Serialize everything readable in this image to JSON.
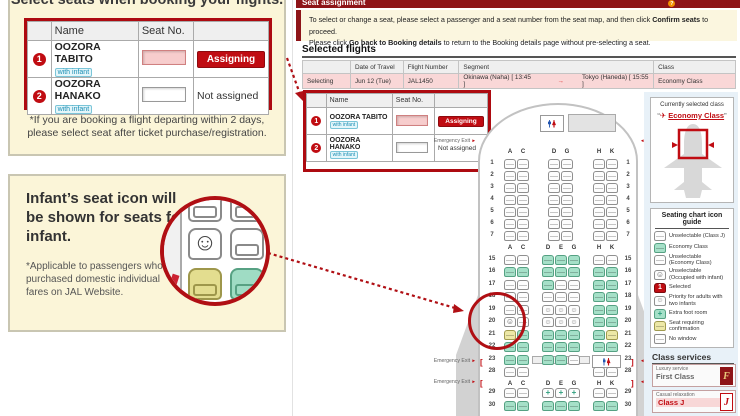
{
  "colors": {
    "brand_red": "#AD0A10",
    "accent_red": "#C00C12",
    "seat_available_green": "#A5E0C8",
    "seat_confirm_yellow": "#EDE8A6",
    "flight_row_pink": "#F9D7D7",
    "info_bg_yellow": "#FBF5D8"
  },
  "left": {
    "box1": {
      "title": "Select seats when booking your flights.",
      "note1": "*If you are booking a flight departing within 2 days,",
      "note2": "please select seat after ticket purchase/registration."
    },
    "box2": {
      "title": "Infant’s seat icon will be shown for seats for infant.",
      "note": "*Applicable to passengers who purchased domestic individual fares on JAL Website."
    }
  },
  "header": {
    "title": "Seat assignment",
    "help": "How to use this page",
    "instructions": [
      [
        {
          "t": "To select or change a seat, please select a passenger and a seat number from the seat map, and then click "
        },
        {
          "t": "Confirm seats",
          "b": true
        },
        {
          "t": " to proceed."
        }
      ],
      [
        {
          "t": "Please click "
        },
        {
          "t": "Go back to Booking details",
          "b": true
        },
        {
          "t": " to return to the Booking details page without pre-selecting a seat."
        }
      ]
    ]
  },
  "selected_flights": {
    "heading": "Selected flights",
    "headers": [
      "",
      "Date of Travel",
      "Flight Number",
      "Segment",
      "Class"
    ],
    "row": {
      "status": "Selecting",
      "date": "Jun 12 (Tue)",
      "flight": "JAL1450",
      "seg_from": "Okinawa (Naha) [ 13:45 ]",
      "arrow": "→",
      "seg_to": "Tokyo (Haneda) [ 15:55 ]",
      "class": "Economy Class"
    }
  },
  "passengers": {
    "headers": [
      "Name",
      "Seat No."
    ],
    "rows": [
      {
        "num": "1",
        "name": "OOZORA TABITO",
        "badge": "with infant",
        "status": "Assigning",
        "assigning": true
      },
      {
        "num": "2",
        "name": "OOZORA HANAKO",
        "badge": "with infant",
        "status": "Not assigned",
        "assigning": false
      }
    ]
  },
  "seat_map": {
    "exit_label": "Emergency Exit",
    "letters_j": [
      "A",
      "C",
      "D",
      "G",
      "H",
      "K"
    ],
    "letters_e": [
      "A",
      "C",
      "D",
      "E",
      "G",
      "H",
      "K"
    ],
    "letters_exit28": [
      "A",
      "C",
      "H",
      "K"
    ],
    "rows": [
      {
        "num": "1",
        "section": "j",
        "cols": {
          "A": "w",
          "C": "w",
          "D": "w",
          "G": "w",
          "H": "w",
          "K": "w"
        }
      },
      {
        "num": "2",
        "section": "j",
        "cols": {
          "A": "w",
          "C": "w",
          "D": "w",
          "G": "w",
          "H": "w",
          "K": "w"
        }
      },
      {
        "num": "3",
        "section": "j",
        "cols": {
          "A": "w",
          "C": "w",
          "D": "w",
          "G": "w",
          "H": "w",
          "K": "w"
        }
      },
      {
        "num": "4",
        "section": "j",
        "cols": {
          "A": "w",
          "C": "w",
          "D": "w",
          "G": "w",
          "H": "w",
          "K": "w"
        }
      },
      {
        "num": "5",
        "section": "j",
        "cols": {
          "A": "w",
          "C": "w",
          "D": "w",
          "G": "w",
          "H": "w",
          "K": "w"
        }
      },
      {
        "num": "6",
        "section": "j",
        "cols": {
          "A": "w",
          "C": "w",
          "D": "w",
          "G": "w",
          "H": "w",
          "K": "w"
        }
      },
      {
        "num": "7",
        "section": "j",
        "cols": {
          "A": "w",
          "C": "w",
          "D": "w",
          "G": "w",
          "H": "w",
          "K": "w"
        }
      },
      {
        "num": "15",
        "section": "e",
        "cols": {
          "A": "w",
          "C": "w",
          "D": "g",
          "E": "g",
          "G": "g",
          "H": "w",
          "K": "w"
        }
      },
      {
        "num": "16",
        "section": "e",
        "cols": {
          "A": "g",
          "C": "g",
          "D": "g",
          "E": "g",
          "G": "g",
          "H": "g",
          "K": "g"
        }
      },
      {
        "num": "17",
        "section": "e",
        "cols": {
          "A": "w",
          "C": "w",
          "D": "g",
          "E": "w",
          "G": "w",
          "H": "g",
          "K": "g"
        }
      },
      {
        "num": "18",
        "section": "e",
        "cols": {
          "A": "w",
          "C": "w",
          "D": "w",
          "E": "w",
          "G": "w",
          "H": "g",
          "K": "g"
        }
      },
      {
        "num": "19",
        "section": "e",
        "cols": {
          "A": "w",
          "C": "w",
          "D": "p",
          "E": "p",
          "G": "p",
          "H": "g",
          "K": "g"
        }
      },
      {
        "num": "20",
        "section": "e",
        "cols": {
          "A": "b",
          "C": "w",
          "D": "p",
          "E": "p",
          "G": "p",
          "H": "g",
          "K": "g"
        }
      },
      {
        "num": "21",
        "section": "e",
        "cols": {
          "A": "y",
          "C": "g",
          "D": "g",
          "E": "g",
          "G": "g",
          "H": "g",
          "K": "y"
        }
      },
      {
        "num": "22",
        "section": "e",
        "cols": {
          "A": "g",
          "C": "g",
          "D": "g",
          "E": "g",
          "G": "g",
          "H": "g",
          "K": "g"
        }
      },
      {
        "num": "23",
        "section": "e",
        "cols": {
          "A": "g",
          "C": "g",
          "D": "g",
          "E": "g",
          "G": "w",
          "H": "lav",
          "K": ""
        }
      },
      {
        "num": "28",
        "section": "x2",
        "cols": {
          "A": "w",
          "C": "w",
          "H": "w",
          "K": "w"
        }
      },
      {
        "num": "29",
        "section": "e",
        "cols": {
          "A": "w",
          "C": "w",
          "D": "x",
          "E": "x",
          "G": "x",
          "H": "w",
          "K": "w"
        }
      },
      {
        "num": "30",
        "section": "e",
        "cols": {
          "A": "g",
          "C": "g",
          "D": "g",
          "E": "g",
          "G": "g",
          "H": "g",
          "K": "g"
        }
      }
    ]
  },
  "sidebar": {
    "current": {
      "label": "Currently selected class",
      "quote_open": "“",
      "value": "Economy Class",
      "quote_close": "”"
    },
    "legend": {
      "title": "Seating chart icon guide",
      "items": [
        {
          "icon": "w",
          "lines": [
            "Unselectable (Class J)"
          ]
        },
        {
          "icon": "g",
          "lines": [
            "Economy Class"
          ]
        },
        {
          "icon": "w",
          "lines": [
            "Unselectable",
            "(Economy Class)"
          ]
        },
        {
          "icon": "b",
          "lines": [
            "Unselectable",
            "(Occupied with infant)"
          ]
        },
        {
          "icon": "sel",
          "lines": [
            "Selected"
          ]
        },
        {
          "icon": "p",
          "lines": [
            "Priority for adults with",
            "two infants"
          ]
        },
        {
          "icon": "xg",
          "lines": [
            "Extra foot room"
          ]
        },
        {
          "icon": "y",
          "lines": [
            "Seat requiring",
            "confirmation"
          ]
        },
        {
          "icon": "nw",
          "lines": [
            "No window"
          ]
        }
      ]
    },
    "class_services": {
      "heading": "Class services",
      "items": [
        {
          "tag": "Luxury service",
          "name": "First Class",
          "badge": "F"
        },
        {
          "tag": "Casual relaxation",
          "name": "Class J",
          "badge": "J"
        }
      ]
    }
  }
}
